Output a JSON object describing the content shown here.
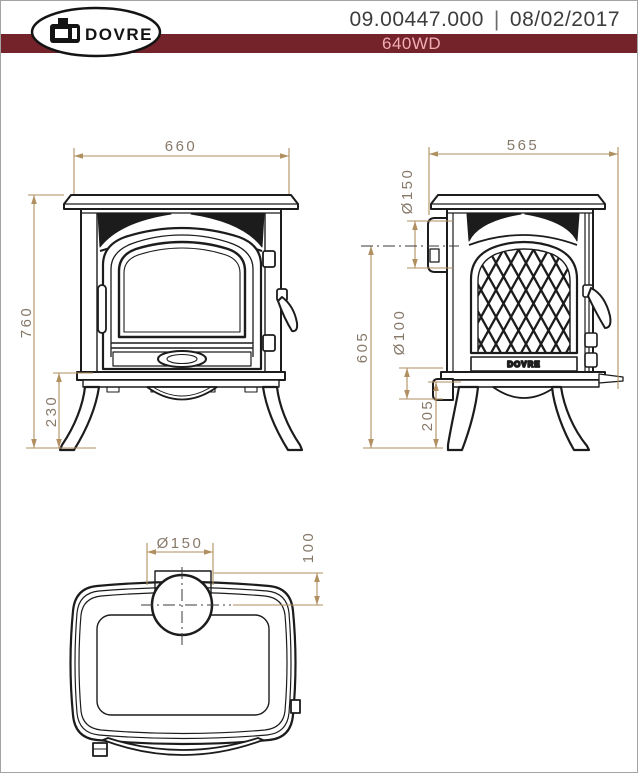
{
  "header": {
    "logo_text": "DOVRE",
    "doc_number": "09.00447.000",
    "separator": "|",
    "date": "08/02/2017",
    "model": "640WD"
  },
  "dimensions": {
    "front_width": "660",
    "total_height": "760",
    "leg_height": "230",
    "depth": "565",
    "flue_collar_dia": "Ø150",
    "flue_center_height": "605",
    "rear_outlet_dia": "Ø100",
    "rear_outlet_height": "205",
    "top_flue_dia": "Ø150",
    "flue_rear_offset": "100"
  },
  "side_plaque": "DOVRE",
  "colors": {
    "band": "#74232b",
    "model_text": "#f0adb4",
    "header_text": "#3d3d3d",
    "line": "#1c1c1c",
    "dim_line": "#b08f60",
    "dim_text": "#87796a",
    "page_border": "#a3a3a3",
    "logo_ink": "#141414"
  }
}
